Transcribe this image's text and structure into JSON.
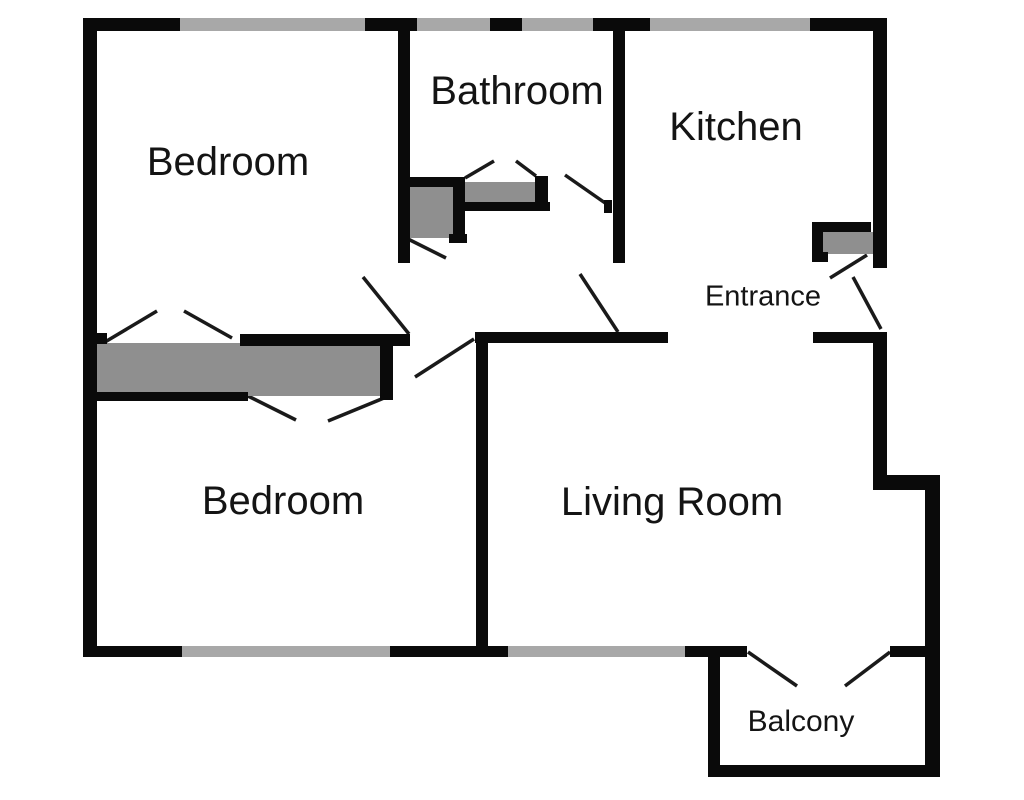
{
  "title": "Apartment floor plan",
  "colors": {
    "wall": "#0a0a0a",
    "window": "#a8a8a8",
    "furniture": "#8f8f8f",
    "door_line": "#1a1a1a",
    "text": "#141414",
    "background": "#ffffff"
  },
  "canvas": {
    "width": 1024,
    "height": 800
  },
  "rooms": [
    {
      "label": "Bedroom",
      "cx": 228,
      "cy": 162,
      "size": 40
    },
    {
      "label": "Bathroom",
      "cx": 517,
      "cy": 91,
      "size": 40
    },
    {
      "label": "Kitchen",
      "cx": 736,
      "cy": 127,
      "size": 40
    },
    {
      "label": "Entrance",
      "cx": 763,
      "cy": 297,
      "size": 29
    },
    {
      "label": "Bedroom",
      "cx": 283,
      "cy": 501,
      "size": 40
    },
    {
      "label": "Living Room",
      "cx": 672,
      "cy": 502,
      "size": 40
    },
    {
      "label": "Balcony",
      "cx": 801,
      "cy": 722,
      "size": 30
    }
  ],
  "walls": [
    {
      "name": "top-wall-seg-1",
      "x": 83,
      "y": 18,
      "w": 97,
      "h": 13
    },
    {
      "name": "top-wall-seg-2",
      "x": 365,
      "y": 18,
      "w": 52,
      "h": 13
    },
    {
      "name": "top-wall-seg-3",
      "x": 490,
      "y": 18,
      "w": 32,
      "h": 13
    },
    {
      "name": "top-wall-seg-4",
      "x": 593,
      "y": 18,
      "w": 57,
      "h": 13
    },
    {
      "name": "top-wall-seg-5",
      "x": 810,
      "y": 18,
      "w": 77,
      "h": 13
    },
    {
      "name": "left-wall",
      "x": 83,
      "y": 18,
      "w": 14,
      "h": 639
    },
    {
      "name": "right-wall-upper",
      "x": 873,
      "y": 18,
      "w": 14,
      "h": 250
    },
    {
      "name": "right-wall-mid",
      "x": 873,
      "y": 332,
      "w": 14,
      "h": 143
    },
    {
      "name": "right-step-wall",
      "x": 873,
      "y": 475,
      "w": 67,
      "h": 15
    },
    {
      "name": "right-wall-lower",
      "x": 925,
      "y": 475,
      "w": 15,
      "h": 300
    },
    {
      "name": "balcony-bottom-wall",
      "x": 708,
      "y": 765,
      "w": 232,
      "h": 12
    },
    {
      "name": "balcony-left-wall",
      "x": 708,
      "y": 657,
      "w": 12,
      "h": 108
    },
    {
      "name": "bottom-wall-seg-1",
      "x": 83,
      "y": 646,
      "w": 99,
      "h": 11
    },
    {
      "name": "bottom-wall-seg-2",
      "x": 390,
      "y": 646,
      "w": 118,
      "h": 11
    },
    {
      "name": "bottom-wall-seg-3",
      "x": 685,
      "y": 646,
      "w": 62,
      "h": 11
    },
    {
      "name": "bottom-wall-seg-4",
      "x": 890,
      "y": 646,
      "w": 38,
      "h": 11
    },
    {
      "name": "bathroom-left-wall",
      "x": 398,
      "y": 30,
      "w": 12,
      "h": 233
    },
    {
      "name": "kitchen-left-wall",
      "x": 613,
      "y": 30,
      "w": 12,
      "h": 233
    },
    {
      "name": "hall-wall-left",
      "x": 475,
      "y": 332,
      "w": 193,
      "h": 11
    },
    {
      "name": "hall-wall-right",
      "x": 813,
      "y": 332,
      "w": 60,
      "h": 11
    },
    {
      "name": "closet-top-bar",
      "x": 240,
      "y": 334,
      "w": 170,
      "h": 12
    },
    {
      "name": "closet-left-stub",
      "x": 93,
      "y": 333,
      "w": 14,
      "h": 11
    },
    {
      "name": "closet-bottom-bar",
      "x": 93,
      "y": 392,
      "w": 155,
      "h": 9
    },
    {
      "name": "closet-right-bar",
      "x": 380,
      "y": 334,
      "w": 13,
      "h": 66
    },
    {
      "name": "bedroom-divider-wall",
      "x": 476,
      "y": 338,
      "w": 12,
      "h": 309
    }
  ],
  "windows": [
    {
      "name": "bedroom1-window",
      "x": 180,
      "y": 18,
      "w": 185,
      "h": 13
    },
    {
      "name": "bathroom-window-1",
      "x": 417,
      "y": 18,
      "w": 73,
      "h": 13
    },
    {
      "name": "bathroom-window-2",
      "x": 522,
      "y": 18,
      "w": 71,
      "h": 13
    },
    {
      "name": "kitchen-window",
      "x": 650,
      "y": 18,
      "w": 160,
      "h": 13
    },
    {
      "name": "bedroom2-window",
      "x": 182,
      "y": 646,
      "w": 208,
      "h": 11
    },
    {
      "name": "living-room-window",
      "x": 508,
      "y": 646,
      "w": 177,
      "h": 11
    }
  ],
  "furniture": [
    {
      "name": "closet-1",
      "x": 97,
      "y": 343,
      "w": 151,
      "h": 49
    },
    {
      "name": "closet-2",
      "x": 248,
      "y": 345,
      "w": 132,
      "h": 51
    },
    {
      "name": "shower",
      "x": 410,
      "y": 187,
      "w": 45,
      "h": 51
    },
    {
      "name": "bathroom-vanity",
      "x": 462,
      "y": 182,
      "w": 75,
      "h": 20
    },
    {
      "name": "entrance-cabinet",
      "x": 823,
      "y": 232,
      "w": 50,
      "h": 22
    }
  ],
  "furniture_bars": [
    {
      "name": "shower-top-bar",
      "x": 404,
      "y": 177,
      "w": 61,
      "h": 10
    },
    {
      "name": "shower-right-bar",
      "x": 453,
      "y": 182,
      "w": 12,
      "h": 61
    },
    {
      "name": "shower-foot",
      "x": 449,
      "y": 234,
      "w": 18,
      "h": 9
    },
    {
      "name": "vanity-right-bar",
      "x": 535,
      "y": 176,
      "w": 13,
      "h": 30
    },
    {
      "name": "vanity-bottom-bar",
      "x": 460,
      "y": 202,
      "w": 90,
      "h": 9
    },
    {
      "name": "entrance-cab-top-bar",
      "x": 812,
      "y": 222,
      "w": 59,
      "h": 10
    },
    {
      "name": "entrance-cab-left-bar",
      "x": 812,
      "y": 222,
      "w": 11,
      "h": 40
    },
    {
      "name": "entrance-cab-foot",
      "x": 812,
      "y": 252,
      "w": 16,
      "h": 10
    },
    {
      "name": "bathroom-door-stop",
      "x": 604,
      "y": 200,
      "w": 8,
      "h": 13
    }
  ],
  "doors": [
    {
      "name": "closet1-bifold-left",
      "x1": 105,
      "y1": 342,
      "x2": 157,
      "y2": 311
    },
    {
      "name": "closet1-bifold-right",
      "x1": 184,
      "y1": 311,
      "x2": 232,
      "y2": 338
    },
    {
      "name": "closet2-bifold-left",
      "x1": 248,
      "y1": 396,
      "x2": 296,
      "y2": 420
    },
    {
      "name": "closet2-bifold-right",
      "x1": 328,
      "y1": 421,
      "x2": 384,
      "y2": 398
    },
    {
      "name": "bedroom1-door",
      "x1": 363,
      "y1": 277,
      "x2": 409,
      "y2": 334
    },
    {
      "name": "bedroom2-door",
      "x1": 415,
      "y1": 377,
      "x2": 474,
      "y2": 339
    },
    {
      "name": "bathroom-door",
      "x1": 565,
      "y1": 175,
      "x2": 608,
      "y2": 205
    },
    {
      "name": "bathroom-inner-door",
      "x1": 406,
      "y1": 238,
      "x2": 446,
      "y2": 258
    },
    {
      "name": "vanity-bifold-left",
      "x1": 465,
      "y1": 178,
      "x2": 494,
      "y2": 161
    },
    {
      "name": "vanity-bifold-right",
      "x1": 516,
      "y1": 161,
      "x2": 536,
      "y2": 176
    },
    {
      "name": "kitchen-door",
      "x1": 580,
      "y1": 274,
      "x2": 618,
      "y2": 332
    },
    {
      "name": "entrance-door-leaf-1",
      "x1": 830,
      "y1": 278,
      "x2": 867,
      "y2": 255
    },
    {
      "name": "entrance-door-leaf-2",
      "x1": 853,
      "y1": 277,
      "x2": 881,
      "y2": 329
    },
    {
      "name": "balcony-door-left",
      "x1": 748,
      "y1": 652,
      "x2": 797,
      "y2": 686
    },
    {
      "name": "balcony-door-right",
      "x1": 845,
      "y1": 686,
      "x2": 890,
      "y2": 652
    }
  ]
}
